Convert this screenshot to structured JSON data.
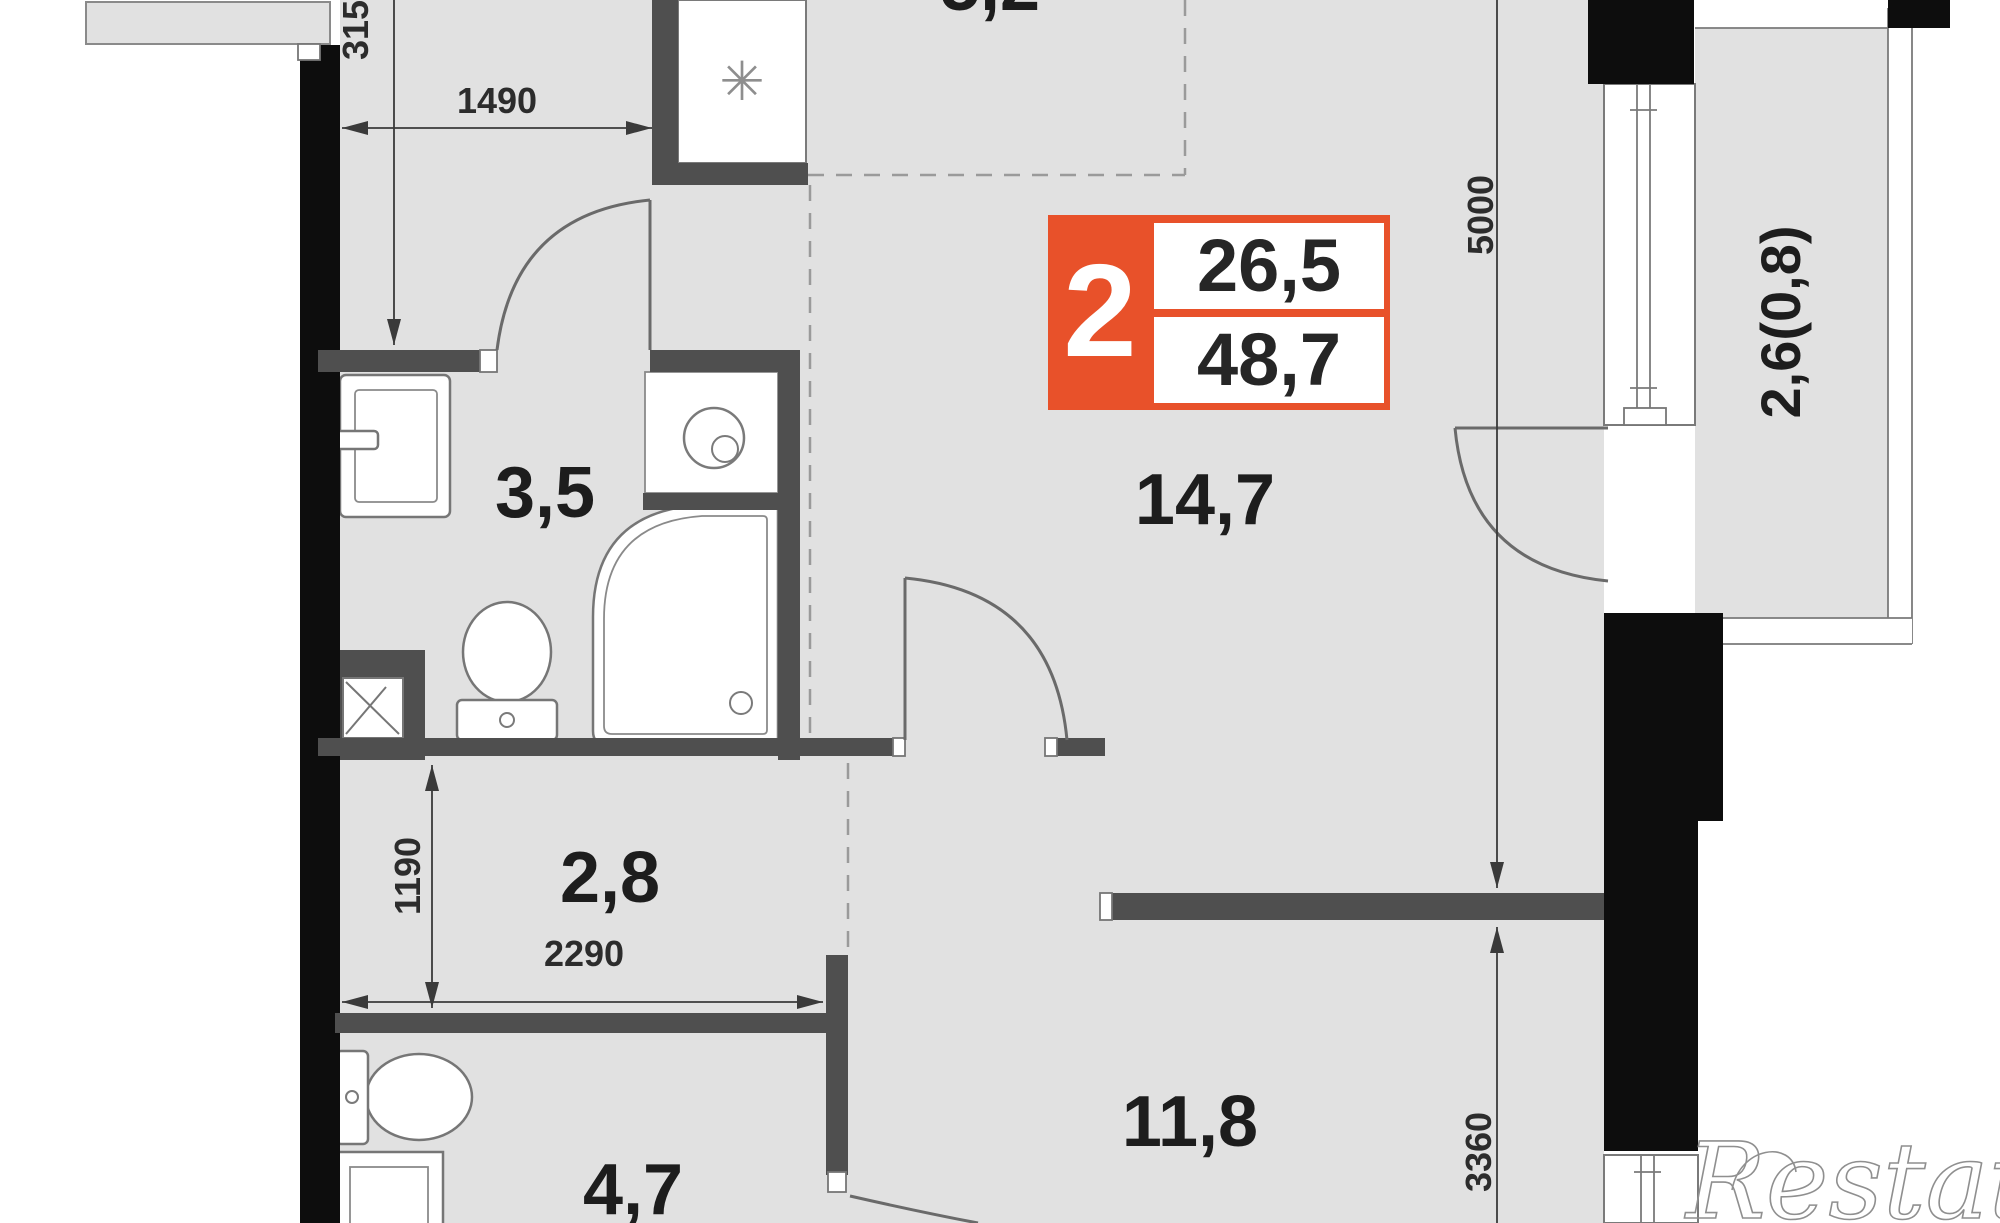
{
  "plan": {
    "badge": {
      "room_count": "2",
      "area_living": "26,5",
      "area_total": "48,7"
    },
    "labels": {
      "bathroom": "3,5",
      "hall": "2,8",
      "wc": "4,7",
      "living": "14,7",
      "bedroom": "11,8",
      "balcony": "2,6(0,8)",
      "kitchen_partial": "5,2"
    },
    "dimensions": {
      "d1490": "1490",
      "d3150": "3150",
      "d1190": "1190",
      "d2290": "2290",
      "d5000": "5000",
      "d3360": "3360"
    },
    "icons": {
      "snowflake": "✳"
    },
    "watermark": "Restate",
    "colors": {
      "accent_orange": "#e8512a",
      "floor_gray": "#e1e1e1",
      "wall_gray": "#4f4f4f",
      "wall_black": "#0d0d0d"
    }
  }
}
